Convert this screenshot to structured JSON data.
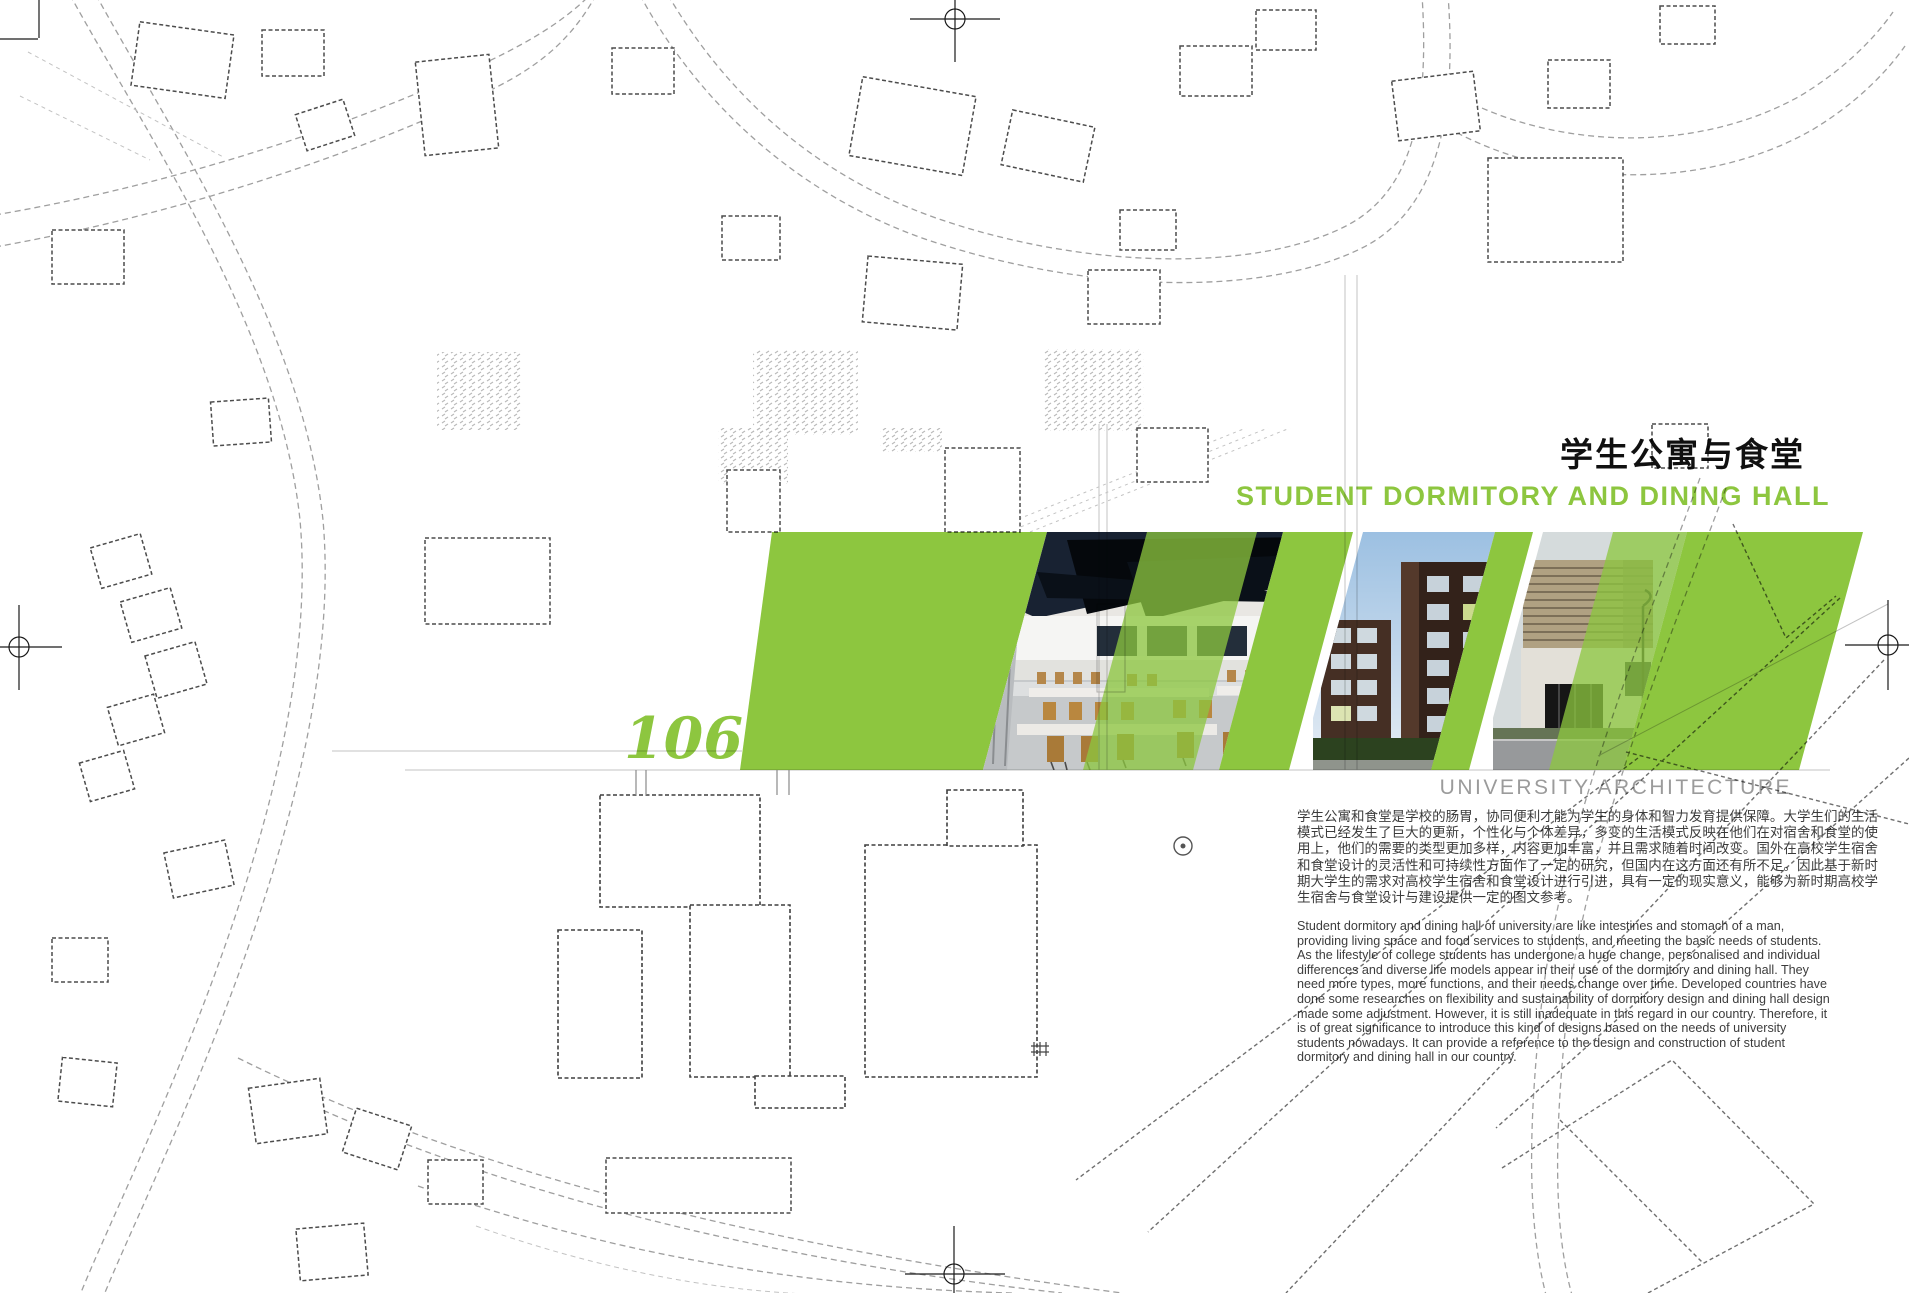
{
  "page": {
    "number": "106",
    "title_zh": "学生公寓与食堂",
    "title_en": "STUDENT DORMITORY AND DINING HALL",
    "category": "UNIVERSITY ARCHITECTURE",
    "intro_zh": "学生公寓和食堂是学校的肠胃，协同便利才能为学生的身体和智力发育提供保障。大学生们的生活模式已经发生了巨大的更新，个性化与个体差异，多变的生活模式反映在他们在对宿舍和食堂的使用上，他们的需要的类型更加多样，内容更加丰富，并且需求随着时间改变。国外在高校学生宿舍和食堂设计的灵活性和可持续性方面作了一定的研究，但国内在这方面还有所不足。因此基于新时期大学生的需求对高校学生宿舍和食堂设计进行引进，具有一定的现实意义，能够为新时期高校学生宿舍与食堂设计与建设提供一定的图文参考。",
    "intro_en": "Student dormitory and dining hall of university are like intestines and stomach of a man, providing living space and food services to students, and meeting the basic needs of students. As the lifestyle of college students has undergone a huge change, personalised and individual differences and diverse life models appear in their use of the dormitory and dining hall. They need more types, more functions, and their needs change over time. Developed countries have done some researches on flexibility and sustainability of dormitory design and dining hall design made some adjustment. However, it is still inadequate in this regard in our country. Therefore, it is of great significance to introduce this kind of designs based on the needs of university students nowadays. It can provide a reference to the design and construction of student dormitory and dining hall in our country."
  },
  "photos": [
    {
      "name": "dining-hall-interior"
    },
    {
      "name": "brick-dormitory-buildings"
    },
    {
      "name": "dining-hall-street-exterior"
    }
  ],
  "colors": {
    "accent_green": "#8dc63f",
    "title_black": "#101010",
    "body_text": "#3c3c3c",
    "category_gray": "#9b9b9b"
  }
}
